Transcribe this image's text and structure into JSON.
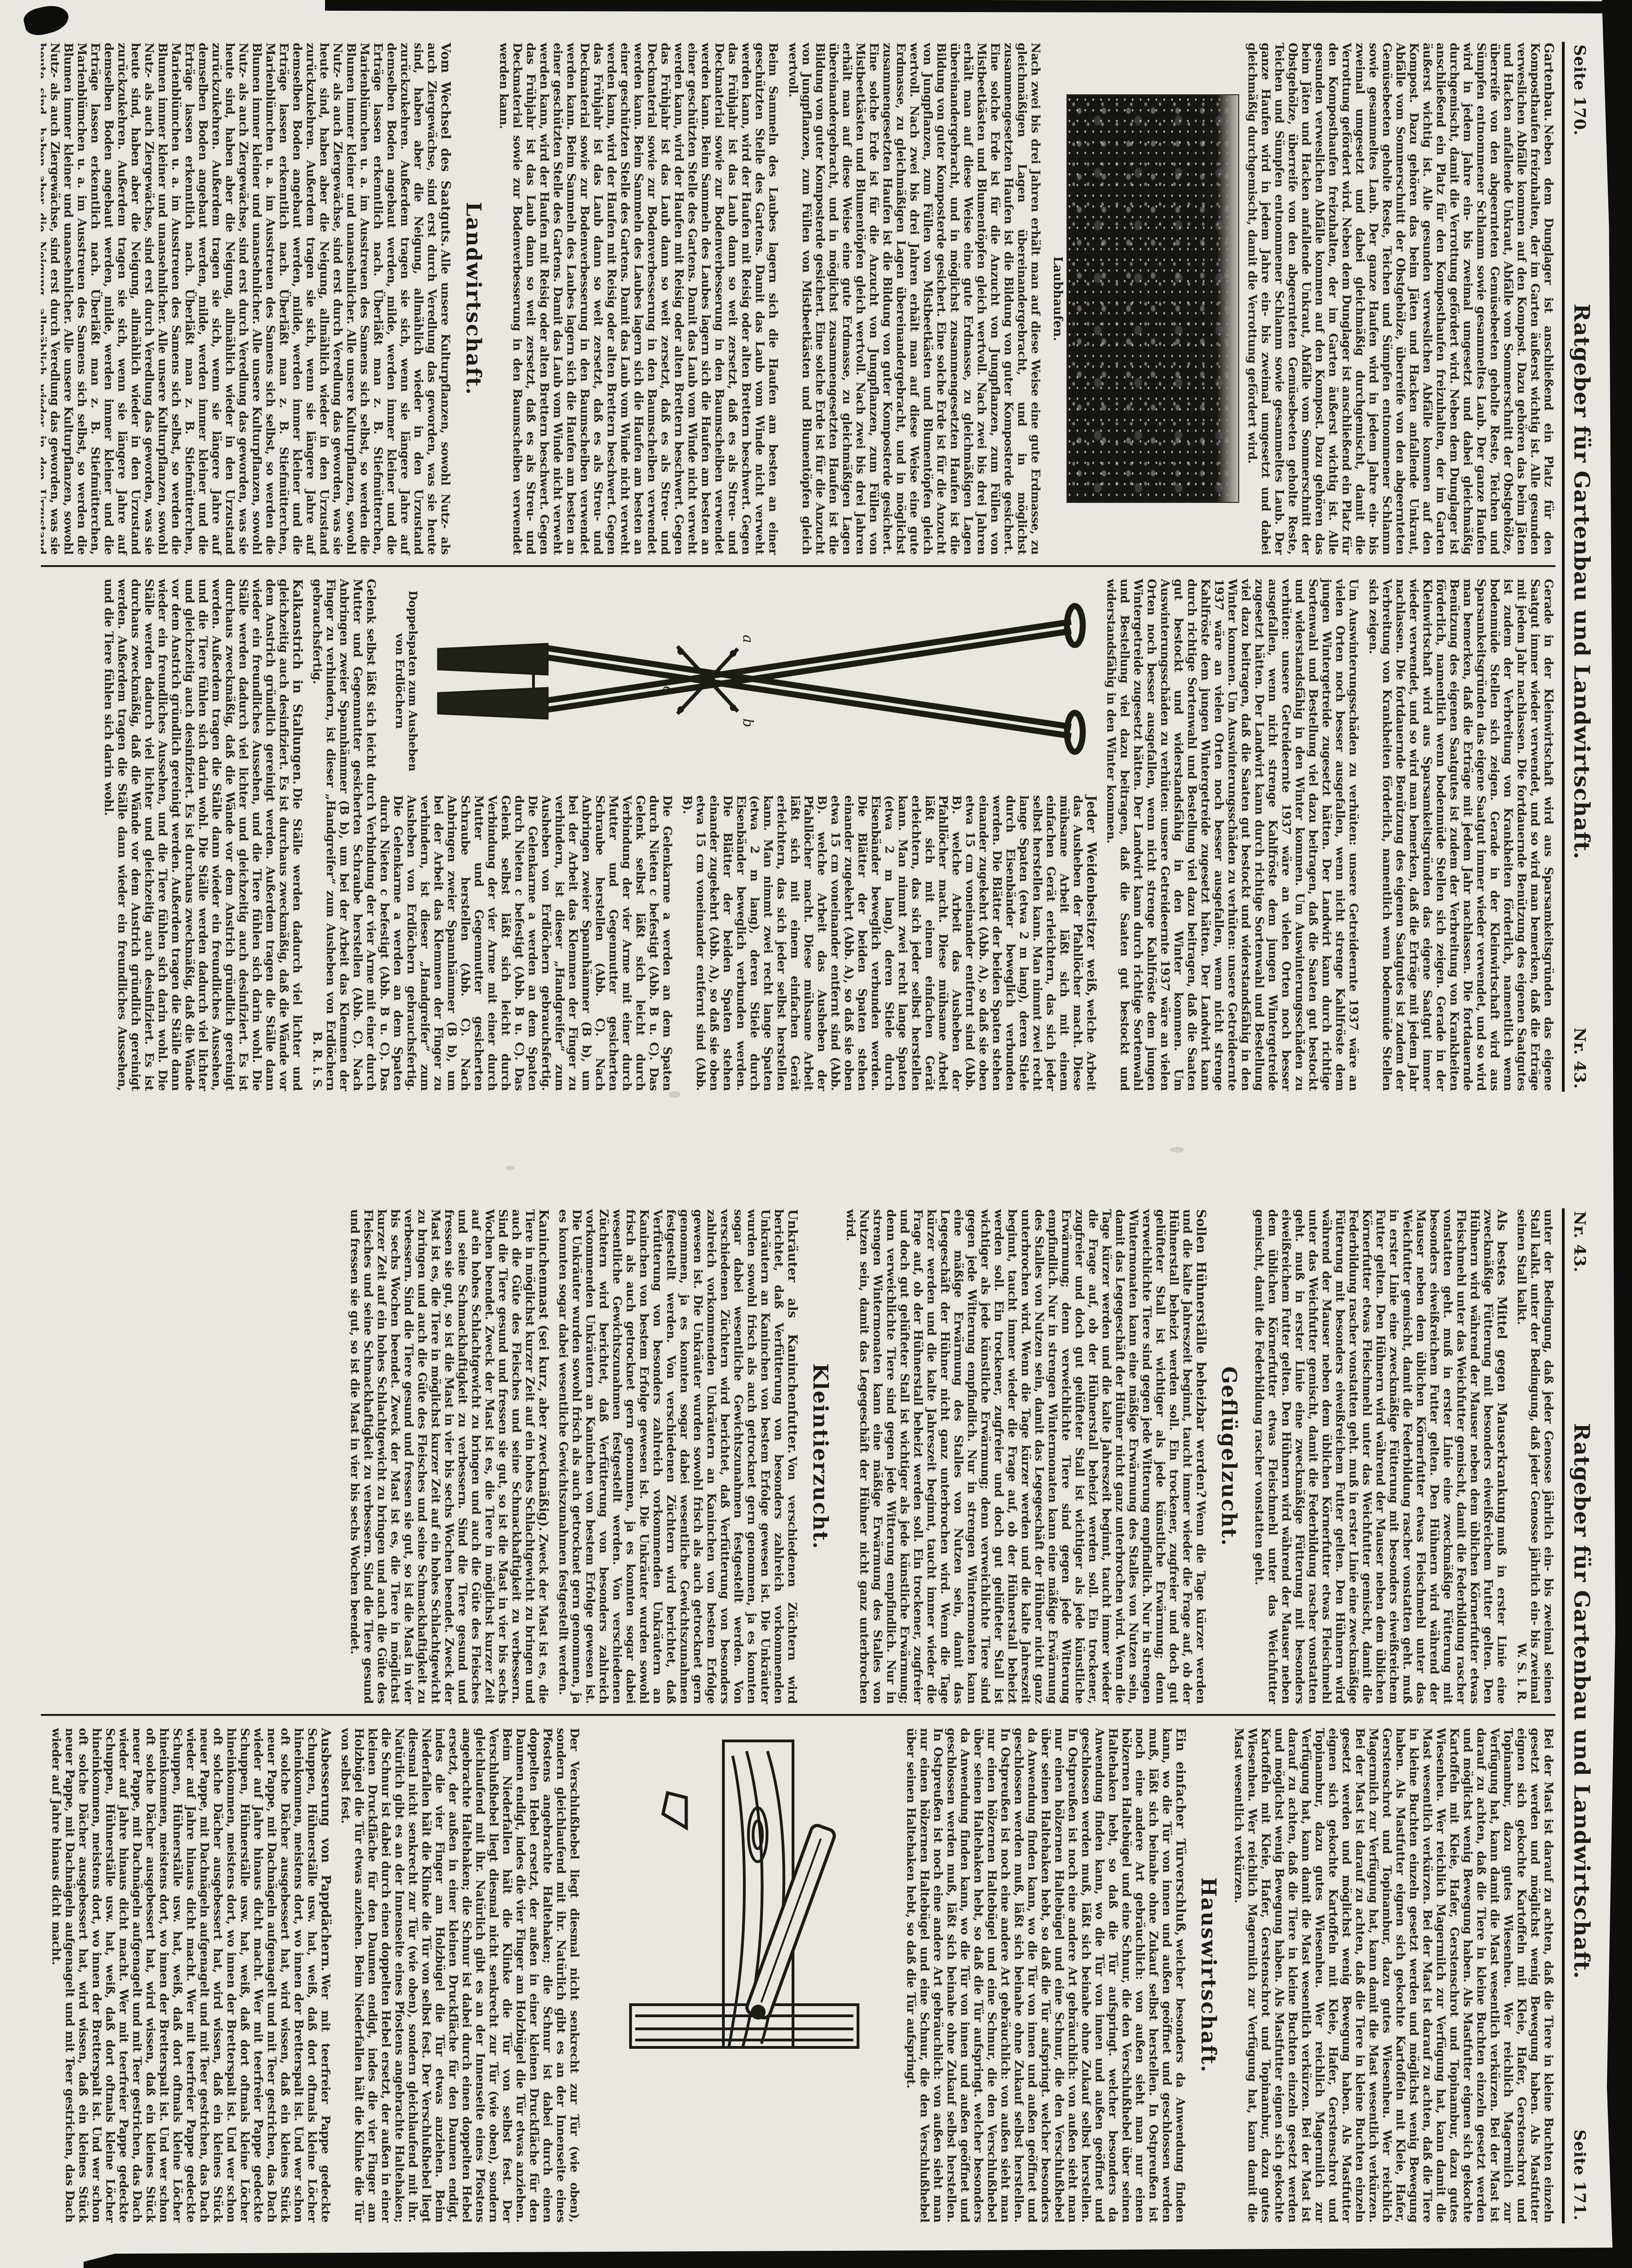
{
  "colors": {
    "paper": "#e8e7e2",
    "ink": "#1b1b18",
    "scan_border": "#0d0d0b"
  },
  "page170": {
    "header": {
      "page_label": "Seite 170.",
      "title": "Ratgeber für Gartenbau und Landwirtschaft.",
      "issue_label": "Nr. 43."
    },
    "col1": {
      "articles": [
        {
          "lead": "Gartenbau.",
          "body": "Neben dem Dunglager ist anschließend ein Platz für den Komposthaufen freizuhalten, der im Garten äußerst wichtig ist. Alle gesunden verweslichen Abfälle kommen auf den Kompost. Dazu gehören das beim Jäten und Hacken anfallende Unkraut, Abfälle vom Sommerschnitt der Obstgehölze, überreife von den abgeernteten Gemüsebeeten geholte Reste, Teichen und Sümpfen entnommener Schlamm sowie gesammeltes Laub. Der ganze Haufen wird in jedem Jahre ein- bis zweimal umgesetzt und dabei gleichmäßig durchgemischt, damit die Verrottung gefördert wird."
        },
        {
          "body": "Nach zwei bis drei Jahren erhält man auf diese Weise eine gute Erdmasse, zu gleichmäßigen Lagen übereinandergebracht, und in möglichst zusammengesetzten Haufen ist die Bildung von guter Komposterde gesichert. Eine solche Erde ist für die Anzucht von Jungpflanzen, zum Füllen von Mistbeetkästen und Blumentöpfen gleich wertvoll."
        },
        {
          "body": "Beim Sammeln des Laubes lagern sich die Haufen am besten an einer geschützten Stelle des Gartens. Damit das Laub vom Winde nicht verweht werden kann, wird der Haufen mit Reisig oder alten Brettern beschwert. Gegen das Frühjahr ist das Laub dann so weit zersetzt, daß es als Streu- und Deckmaterial sowie zur Bodenverbesserung in den Baumscheiben verwendet werden kann."
        },
        {
          "lead": "Vom Wechsel des Saatguts.",
          "body": "Alle unsere Kulturpflanzen, sowohl Nutz- als auch Ziergewächse, sind erst durch Veredlung das geworden, was sie heute sind, haben aber die Neigung, allmählich wieder in den Urzustand zurückzukehren. Außerdem tragen sie sich, wenn sie längere Jahre auf demselben Boden angebaut werden, milde, werden immer kleiner und die Erträge lassen erkenntlich nach. Überläßt man z. B. Stiefmütterchen, Marienblümchen u. a. im Ausstreuen des Samens sich selbst, so werden die Blumen immer kleiner und unansehnlicher."
        }
      ],
      "photo_caption": "Laubhaufen.",
      "section_heading": "Landwirtschaft."
    },
    "col2": {
      "articles": [
        {
          "body": "Gerade in der Kleinwirtschaft wird aus Sparsamkeitsgründen das eigene Saatgut immer wieder verwendet, und so wird man bemerken, daß die Erträge mit jedem Jahr nachlassen. Die fortdauernde Benützung des eigenen Saatgutes ist zudem der Verbreitung von Krankheiten förderlich, namentlich wenn bodenmüde Stellen sich zeigen."
        },
        {
          "body": "Um Auswinterungsschäden zu verhüten: unsere Getreideernte 1937 wäre an vielen Orten noch besser ausgefallen, wenn nicht strenge Kahlfröste dem jungen Wintergetreide zugesetzt hätten. Der Landwirt kann durch richtige Sortenwahl und Bestellung viel dazu beitragen, daß die Saaten gut bestockt und widerstandsfähig in den Winter kommen."
        },
        {
          "lead": "Jeder Weidenbesitzer weiß,",
          "body": "welche Arbeit das Ausheben der Pfahllöcher macht. Diese mühsame Arbeit läßt sich mit einem einfachen Gerät erleichtern, das sich jeder selbst herstellen kann. Man nimmt zwei recht lange Spaten (etwa 2 m lang), deren Stiele durch Eisenbänder beweglich verbunden werden. Die Blätter der beiden Spaten stehen einander zugekehrt (Abb. A), so daß sie oben etwa 15 cm voneinander entfernt sind (Abb. B)."
        },
        {
          "body": "Die Gelenkarme a werden an dem Spaten durch Nieten c befestigt (Abb. B u. C). Das Gelenk selbst läßt sich leicht durch Verbindung der vier Arme mit einer durch Mutter und Gegenmutter gesicherten Schraube herstellen (Abb. C). Nach Anbringen zweier Spannhämmer (B b), um bei der Arbeit das Klemmen der Finger zu verhindern, ist dieser „Handgreifer“ zum Ausheben von Erdlöchern gebrauchsfertig.",
          "sig": "B. R. i. S."
        },
        {
          "lead": "Kalkanstrich in Stallungen.",
          "body": "Die Ställe werden dadurch viel lichter und gleichzeitig auch desinfiziert. Es ist durchaus zweckmäßig, daß die Wände vor dem Anstrich gründlich gereinigt werden. Außerdem tragen die Ställe dann wieder ein freundliches Aussehen, und die Tiere fühlen sich darin wohl."
        }
      ],
      "figure_caption": "Doppelspaten zum Ausheben von Erdlöchern"
    }
  },
  "page171": {
    "header": {
      "issue_label": "Nr. 43.",
      "title": "Ratgeber für Gartenbau und Landwirtschaft.",
      "page_label": "Seite 171."
    },
    "col1": {
      "articles": [
        {
          "body": "unter der Bedingung, daß jeder Genosse jährlich ein- bis zweimal seinen Stall kalkt.",
          "sig": "W. S. i. R."
        },
        {
          "lead": "Als bestes Mittel gegen Mauserkrankung",
          "body": "muß in erster Linie eine zweckmäßige Fütterung mit besonders eiweißreichem Futter gelten. Den Hühnern wird während der Mauser neben dem üblichen Körnerfutter etwas Fleischmehl unter das Weichfutter gemischt, damit die Federbildung rascher vonstatten geht."
        },
        {
          "lead": "Sollen Hühnerställe beheizbar werden?",
          "body": "Wenn die Tage kürzer werden und die kalte Jahreszeit beginnt, taucht immer wieder die Frage auf, ob der Hühnerstall beheizt werden soll. Ein trockener, zugfreier und doch gut gelüfteter Stall ist wichtiger als jede künstliche Erwärmung; denn verweichlichte Tiere sind gegen jede Witterung empfindlich. Nur in strengen Wintermonaten kann eine mäßige Erwärmung des Stalles von Nutzen sein, damit das Legegeschäft der Hühner nicht ganz unterbrochen wird."
        },
        {
          "lead": "Unkräuter als Kaninchenfutter.",
          "body": "Von verschiedenen Züchtern wird berichtet, daß Verfütterung von besonders zahlreich vorkommenden Unkräutern an Kaninchen von bestem Erfolge gewesen ist. Die Unkräuter wurden sowohl frisch als auch getrocknet gern genommen, ja es konnten sogar dabei wesentliche Gewichtszunahmen festgestellt werden."
        },
        {
          "lead": "Kaninchenmast (sei kurz, aber zweckmäßig).",
          "body": "Zweck der Mast ist es, die Tiere in möglichst kurzer Zeit auf ein hohes Schlachtgewicht zu bringen und auch die Güte des Fleisches und seine Schmackhaftigkeit zu verbessern. Sind die Tiere gesund und fressen sie gut, so ist die Mast in vier bis sechs Wochen beendet."
        }
      ],
      "section_heading_1": "Geflügelzucht.",
      "section_heading_2": "Kleintierzucht."
    },
    "col2": {
      "articles": [
        {
          "body": "Bei der Mast ist darauf zu achten, daß die Tiere in kleine Buchten einzeln gesetzt werden und möglichst wenig Bewegung haben. Als Mastfutter eignen sich gekochte Kartoffeln mit Kleie, Hafer, Gerstenschrot und Topinambur, dazu gutes Wiesenheu. Wer reichlich Magermilch zur Verfügung hat, kann damit die Mast wesentlich verkürzen."
        },
        {
          "lead": "Ein einfacher Türverschluß,",
          "body": "welcher besonders da Anwendung finden kann, wo die Tür von innen und außen geöffnet und geschlossen werden muß, läßt sich beinahe ohne Zukauf selbst herstellen. In Ostpreußen ist noch eine andere Art gebräuchlich: von außen sieht man nur einen hölzernen Haltebügel und eine Schnur, die den Verschlußhebel über seinen Haltehaken hebt, so daß die Tür aufspringt."
        },
        {
          "body": "Der Verschlußhebel liegt diesmal nicht senkrecht zur Tür (wie oben), sondern gleichlaufend mit ihr. Natürlich gibt es an der Innenseite eines Pfostens angebrachte Haltehaken; die Schnur ist dabei durch einen doppelten Hebel ersetzt, der außen in einer kleinen Druckfläche für den Daumen endigt, indes die vier Finger am Holzbügel die Tür etwas anziehen. Beim Niederfallen hält die Klinke die Tür von selbst fest."
        },
        {
          "lead": "Ausbesserung von Pappdächern.",
          "body": "Wer mit teerfreier Pappe gedeckte Schuppen, Hühnerställe usw. hat, weiß, daß dort oftmals kleine Löcher hineinkommen, meistens dort, wo innen der Bretterspalt ist. Und wer schon oft solche Dächer ausgebessert hat, wird wissen, daß ein kleines Stück neuer Pappe, mit Dachnägeln aufgenagelt und mit Teer gestrichen, das Dach wieder auf Jahre hinaus dicht macht."
        }
      ],
      "section_heading": "Hauswirtschaft."
    }
  }
}
